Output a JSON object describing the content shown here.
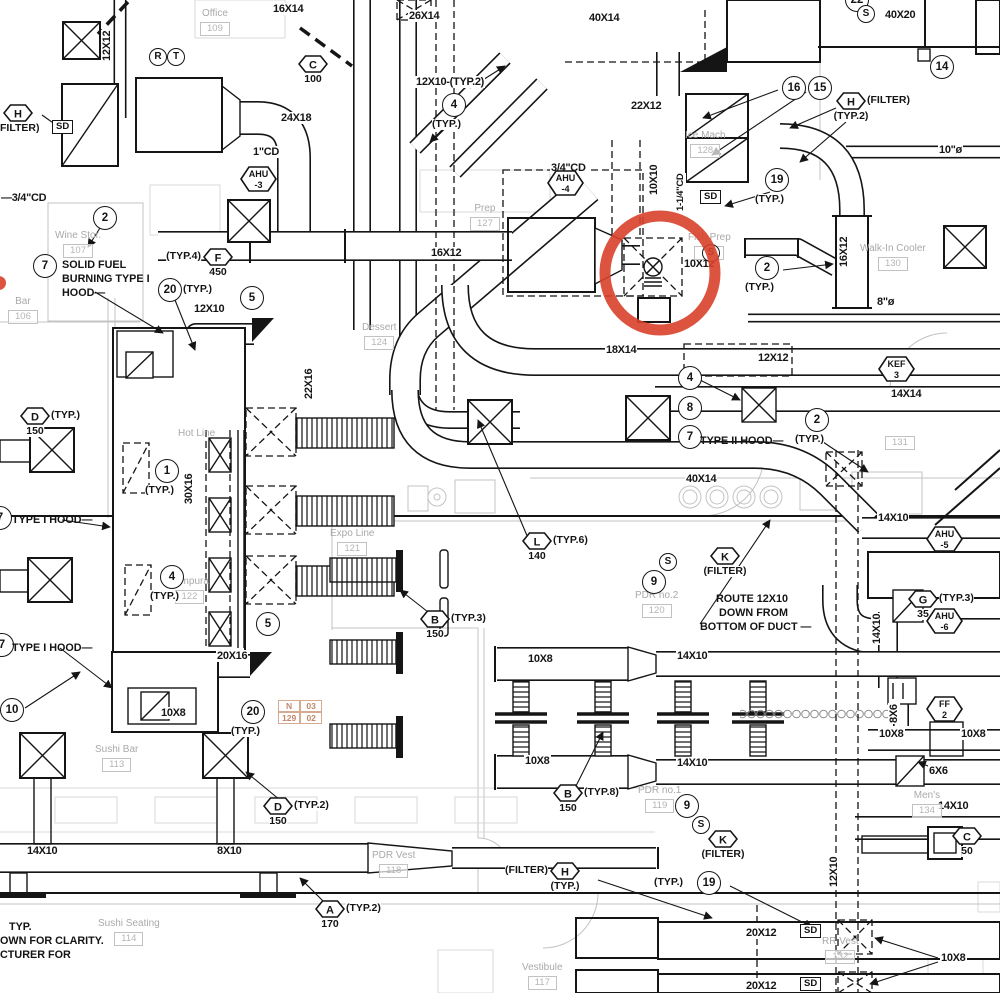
{
  "drawing": {
    "kind": "HVAC mechanical duct plan",
    "line_color": "#151515",
    "architecture_color": "#c3c3c3",
    "room_text_color": "#a9a9a9"
  },
  "highlight": {
    "color": "#d8402a",
    "cx": 660,
    "cy": 273,
    "rx": 55,
    "ry": 57,
    "stroke_width": 11,
    "dot": {
      "cx": -1,
      "cy": 283,
      "r": 7
    }
  },
  "sd_label": "SD",
  "duct_labels": [
    {
      "t": "16X14",
      "x": 272,
      "y": 3
    },
    {
      "t": "26X14",
      "x": 408,
      "y": 10
    },
    {
      "t": "40X14",
      "x": 588,
      "y": 12
    },
    {
      "t": "40X20",
      "x": 884,
      "y": 9
    },
    {
      "t": "12X12",
      "x": 101,
      "y": 62,
      "r": 1
    },
    {
      "t": "12X10-(TYP.2)",
      "x": 415,
      "y": 76
    },
    {
      "t": "22X12",
      "x": 630,
      "y": 100
    },
    {
      "t": "24X18",
      "x": 280,
      "y": 112
    },
    {
      "t": "1\"CD",
      "x": 252,
      "y": 146
    },
    {
      "t": "3/4\"CD",
      "x": 550,
      "y": 162
    },
    {
      "t": "10X10",
      "x": 648,
      "y": 196,
      "r": 1
    },
    {
      "t": "—3/4\"CD",
      "x": 0,
      "y": 192
    },
    {
      "t": "1-1/4\"CD",
      "x": 676,
      "y": 212,
      "r": 1,
      "fs": 9.5
    },
    {
      "t": "10\"ø",
      "x": 938,
      "y": 144
    },
    {
      "t": "16X12",
      "x": 430,
      "y": 247
    },
    {
      "t": "10X12",
      "x": 683,
      "y": 258
    },
    {
      "t": "16X12",
      "x": 838,
      "y": 268,
      "r": 1
    },
    {
      "t": "8\"ø",
      "x": 876,
      "y": 296
    },
    {
      "t": "22X16",
      "x": 303,
      "y": 400,
      "r": 1
    },
    {
      "t": "18X14",
      "x": 605,
      "y": 344
    },
    {
      "t": "12X12",
      "x": 757,
      "y": 352
    },
    {
      "t": "14X14",
      "x": 890,
      "y": 388
    },
    {
      "t": "12X10",
      "x": 193,
      "y": 303
    },
    {
      "t": "30X16",
      "x": 183,
      "y": 505,
      "r": 1
    },
    {
      "t": "40X14",
      "x": 685,
      "y": 473
    },
    {
      "t": "14X10",
      "x": 877,
      "y": 512
    },
    {
      "t": "14X10",
      "x": 871,
      "y": 645,
      "r": 1
    },
    {
      "t": "20X16",
      "x": 216,
      "y": 650
    },
    {
      "t": "10X8",
      "x": 160,
      "y": 707
    },
    {
      "t": "10X8",
      "x": 527,
      "y": 653
    },
    {
      "t": "10X8",
      "x": 524,
      "y": 755
    },
    {
      "t": "14X10",
      "x": 676,
      "y": 650
    },
    {
      "t": "14X10",
      "x": 676,
      "y": 757
    },
    {
      "t": "8X6",
      "x": 888,
      "y": 724,
      "r": 1
    },
    {
      "t": "10X8",
      "x": 878,
      "y": 728
    },
    {
      "t": "10X8",
      "x": 960,
      "y": 728
    },
    {
      "t": "6X6",
      "x": 928,
      "y": 765
    },
    {
      "t": "14X10",
      "x": 937,
      "y": 800
    },
    {
      "t": "14X10",
      "x": 26,
      "y": 845
    },
    {
      "t": "8X10",
      "x": 216,
      "y": 845
    },
    {
      "t": "12X10",
      "x": 828,
      "y": 888,
      "r": 1
    },
    {
      "t": "20X12",
      "x": 745,
      "y": 927
    },
    {
      "t": "20X12",
      "x": 745,
      "y": 980
    },
    {
      "t": "10X8",
      "x": 940,
      "y": 952
    }
  ],
  "keynotes": [
    {
      "n": "22",
      "x": 845,
      "y": -12
    },
    {
      "n": "14",
      "x": 930,
      "y": 55
    },
    {
      "n": "16",
      "x": 782,
      "y": 76
    },
    {
      "n": "15",
      "x": 808,
      "y": 76
    },
    {
      "n": "19",
      "x": 765,
      "y": 168,
      "suf": "(TYP.)",
      "side": "below"
    },
    {
      "n": "2",
      "x": 755,
      "y": 256,
      "suf": "(TYP.)",
      "side": "below"
    },
    {
      "n": "2",
      "x": 93,
      "y": 206
    },
    {
      "n": "7",
      "x": 33,
      "y": 254
    },
    {
      "n": "20",
      "x": 158,
      "y": 278,
      "suf": "(TYP.)",
      "side": "right"
    },
    {
      "n": "5",
      "x": 240,
      "y": 286
    },
    {
      "n": "4",
      "x": 442,
      "y": 93,
      "suf": "(TYP.)",
      "side": "below"
    },
    {
      "n": "4",
      "x": 678,
      "y": 366
    },
    {
      "n": "8",
      "x": 678,
      "y": 396
    },
    {
      "n": "7",
      "x": 678,
      "y": 425
    },
    {
      "n": "1",
      "x": 155,
      "y": 459,
      "suf": "(TYP.)",
      "side": "below"
    },
    {
      "n": "4",
      "x": 160,
      "y": 565,
      "suf": "(TYP.)",
      "side": "below"
    },
    {
      "n": "5",
      "x": 256,
      "y": 612
    },
    {
      "n": "9",
      "x": 642,
      "y": 570
    },
    {
      "n": "10",
      "x": 0,
      "y": 698
    },
    {
      "n": "7",
      "x": -10,
      "y": 633
    },
    {
      "n": "7",
      "x": -12,
      "y": 506
    },
    {
      "n": "20",
      "x": 241,
      "y": 700,
      "suf": "(TYP.)",
      "side": "below"
    },
    {
      "n": "9",
      "x": 675,
      "y": 794
    },
    {
      "n": "19",
      "x": 697,
      "y": 871,
      "suf": "(TYP.)",
      "side": "left"
    },
    {
      "n": "2",
      "x": 805,
      "y": 408,
      "suf": "(TYP.)",
      "side": "below"
    }
  ],
  "letter_circles": [
    {
      "l": "R",
      "x": 149,
      "y": 48
    },
    {
      "l": "T",
      "x": 167,
      "y": 48
    },
    {
      "l": "S",
      "x": 857,
      "y": 5
    },
    {
      "l": "S",
      "x": 702,
      "y": 244
    },
    {
      "l": "S",
      "x": 659,
      "y": 553
    },
    {
      "l": "S",
      "x": 692,
      "y": 816
    }
  ],
  "hex_tags": [
    {
      "l": "C",
      "x": 298,
      "y": 55,
      "val": "100"
    },
    {
      "l": "H",
      "x": 3,
      "y": 104,
      "val": "(FILTER)"
    },
    {
      "l": "H",
      "x": 836,
      "y": 92,
      "suf": "(FILTER)",
      "val": "(TYP.2)"
    },
    {
      "l": "F",
      "x": 203,
      "y": 248,
      "pre": "(TYP.4)",
      "val": "450"
    },
    {
      "l": "D",
      "x": 20,
      "y": 407,
      "suf": "(TYP.)",
      "val": "150"
    },
    {
      "l": "L",
      "x": 522,
      "y": 532,
      "suf": "(TYP.6)",
      "val": "140"
    },
    {
      "l": "B",
      "x": 420,
      "y": 610,
      "suf": "(TYP.3)",
      "val": "150"
    },
    {
      "l": "B",
      "x": 553,
      "y": 784,
      "suf": "(TYP.8)",
      "val": "150"
    },
    {
      "l": "D",
      "x": 263,
      "y": 797,
      "suf": "(TYP.2)",
      "val": "150"
    },
    {
      "l": "K",
      "x": 710,
      "y": 547,
      "val": "(FILTER)"
    },
    {
      "l": "G",
      "x": 908,
      "y": 590,
      "suf": "(TYP.3)",
      "val": "35"
    },
    {
      "l": "K",
      "x": 708,
      "y": 830,
      "val": "(FILTER)"
    },
    {
      "l": "C",
      "x": 952,
      "y": 827,
      "val": "50"
    },
    {
      "l": "A",
      "x": 315,
      "y": 900,
      "suf": "(TYP.2)",
      "val": "170"
    },
    {
      "l": "H",
      "x": 550,
      "y": 862,
      "pre": "(FILTER)",
      "val": "(TYP.)"
    },
    {
      "l1": "FF",
      "l2": "2",
      "x": 926,
      "y": 696
    },
    {
      "l1": "KEF",
      "l2": "3",
      "x": 878,
      "y": 356
    },
    {
      "l1": "AHU",
      "l2": "-3",
      "x": 240,
      "y": 166
    },
    {
      "l1": "AHU",
      "l2": "-4",
      "x": 547,
      "y": 170
    },
    {
      "l1": "AHU",
      "l2": "-5",
      "x": 926,
      "y": 526
    },
    {
      "l1": "AHU",
      "l2": "-6",
      "x": 926,
      "y": 608
    }
  ],
  "sd_boxes": [
    {
      "x": 52,
      "y": 120
    },
    {
      "x": 700,
      "y": 190
    },
    {
      "x": 800,
      "y": 924
    },
    {
      "x": 800,
      "y": 977
    }
  ],
  "rooms": [
    {
      "name": "Office",
      "num": "109",
      "x": 200,
      "y": 8
    },
    {
      "name": "Wine Stor.",
      "num": "107",
      "x": 55,
      "y": 230
    },
    {
      "name": "Bar",
      "num": "106",
      "x": 8,
      "y": 296
    },
    {
      "name": "Prep",
      "num": "127",
      "x": 470,
      "y": 203
    },
    {
      "name": "Dessert",
      "num": "124",
      "x": 362,
      "y": 322
    },
    {
      "name": "Fish Prep",
      "num": "129",
      "x": 688,
      "y": 232
    },
    {
      "name": "Walk-In Cooler",
      "num": "130",
      "x": 860,
      "y": 243
    },
    {
      "name": "Ice Mach",
      "num": "128",
      "x": 685,
      "y": 130
    },
    {
      "name": "Hot Line",
      "num": "",
      "x": 178,
      "y": 428
    },
    {
      "name": "Tempura",
      "num": "122",
      "x": 170,
      "y": 576
    },
    {
      "name": "Expo Line",
      "num": "121",
      "x": 330,
      "y": 528
    },
    {
      "name": "PDR no.2",
      "num": "120",
      "x": 635,
      "y": 590
    },
    {
      "name": "Sushi Bar",
      "num": "113",
      "x": 95,
      "y": 744
    },
    {
      "name": "Sushi Seating",
      "num": "114",
      "x": 98,
      "y": 918
    },
    {
      "name": "PDR Vest",
      "num": "118",
      "x": 372,
      "y": 850
    },
    {
      "name": "PDR no.1",
      "num": "119",
      "x": 638,
      "y": 785
    },
    {
      "name": "Men's",
      "num": "134",
      "x": 912,
      "y": 790
    },
    {
      "name": "Vestibule",
      "num": "117",
      "x": 522,
      "y": 962
    },
    {
      "name": "RR Vest",
      "num": "132",
      "x": 822,
      "y": 936
    },
    {
      "name": "",
      "num": "131",
      "x": 885,
      "y": 434
    }
  ],
  "notes": [
    {
      "lines": [
        "SOLID FUEL",
        "BURNING TYPE I",
        "HOOD—"
      ],
      "x": 62,
      "y": 258
    },
    {
      "lines": [
        "TYPE II HOOD—"
      ],
      "x": 700,
      "y": 434
    },
    {
      "lines": [
        "TYPE I HOOD—"
      ],
      "x": 12,
      "y": 513
    },
    {
      "lines": [
        "TYPE I HOOD—"
      ],
      "x": 12,
      "y": 641
    },
    {
      "lines": [
        "ROUTE 12X10",
        "DOWN FROM",
        "BOTTOM OF DUCT —"
      ],
      "x": 700,
      "y": 592,
      "w": 88,
      "a": "right"
    },
    {
      "lines": [
        "   TYP.",
        "OWN FOR CLARITY.",
        "CTURER FOR"
      ],
      "x": 0,
      "y": 920
    }
  ],
  "grid_ref": {
    "x": 278,
    "y": 700,
    "rows": [
      [
        "N",
        "03"
      ],
      [
        "129",
        "02"
      ]
    ]
  }
}
